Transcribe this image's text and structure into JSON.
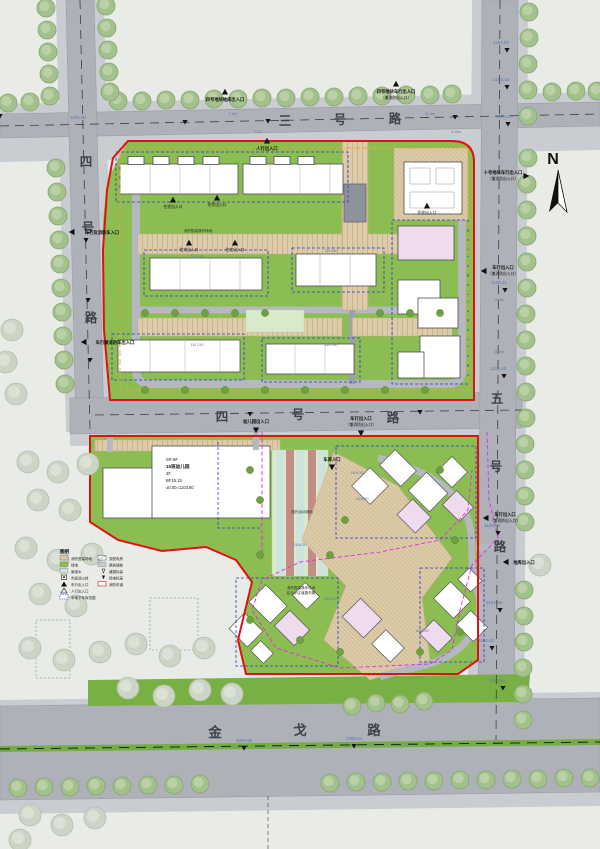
{
  "north_label": "N",
  "roads": {
    "top": [
      "三",
      "号",
      "路"
    ],
    "left": [
      "四",
      "号",
      "路"
    ],
    "middle": [
      "四",
      "号",
      "路"
    ],
    "right": [
      "五",
      "号",
      "路"
    ],
    "bottom": [
      "金",
      "戈",
      "路"
    ]
  },
  "entrances": {
    "garage_top": "四号地块地库出入口",
    "vehicle_top": "四号地块车行出入口",
    "vehicle_top_sub": "（兼消防出入口）",
    "pedestrian": "人行出入口",
    "block10_vehicle": "十号地块车行出入口",
    "block10_vehicle_sub": "（兼消防出入口）",
    "vehicle_generic": "车行出入口",
    "vehicle_generic_sub": "（兼消防出入口）",
    "vehicle_left1": "车行及消防车入口",
    "vehicle_left2": "车行兼消防车出入口",
    "kindergarten": "幼儿园出入口",
    "resident": "住宅出入口",
    "garage_lower": "车库入口",
    "garage_lower2": "地库出入口"
  },
  "elevations": {
    "tl": "1105.90",
    "r1": "1104.83",
    "r2": "1105.16",
    "r3": "1105.47",
    "r4": "1105.21",
    "r5": "1105.18",
    "r6": "1105.08",
    "r7": "1104.66",
    "r8": "1104.52",
    "r9": "1103.64",
    "b1": "1086.85",
    "b2": "1089.64",
    "u1": "1107.50",
    "u2": "1107.80",
    "u3": "1107.50",
    "u4": "1107.80",
    "l1": "1104.50",
    "l2": "1104.50",
    "l3": "1104.00",
    "l4": "1104.00",
    "l5": "1104.30"
  },
  "dims": {
    "d1": "2.5m",
    "d2": "5.12",
    "d3": "11.5m",
    "d4": "4.12m",
    "d5": "11.5m",
    "d6": "10.5m"
  },
  "kindergarten_block": {
    "l1": "SP-5#",
    "l2": "15班幼儿园",
    "l3": "4F",
    "l4": "BF16.15",
    "l5": "±0.00=1103.60"
  },
  "legend": {
    "title": "图例",
    "left": [
      "消防登高场地",
      "绿地",
      "景观水",
      "市政消火栓",
      "车行出入口",
      "人行出入口",
      "半地下车库范围"
    ],
    "right": [
      "变配电房",
      "硬质铺装",
      "道路标高",
      "场地标高",
      "消防车道"
    ]
  },
  "notes": {
    "fire1": "消防登高操作场地",
    "fire_lower1": "消防登高操作场地",
    "fire_lower2": "结合小区道路布置",
    "courts": "室外活动场地"
  }
}
